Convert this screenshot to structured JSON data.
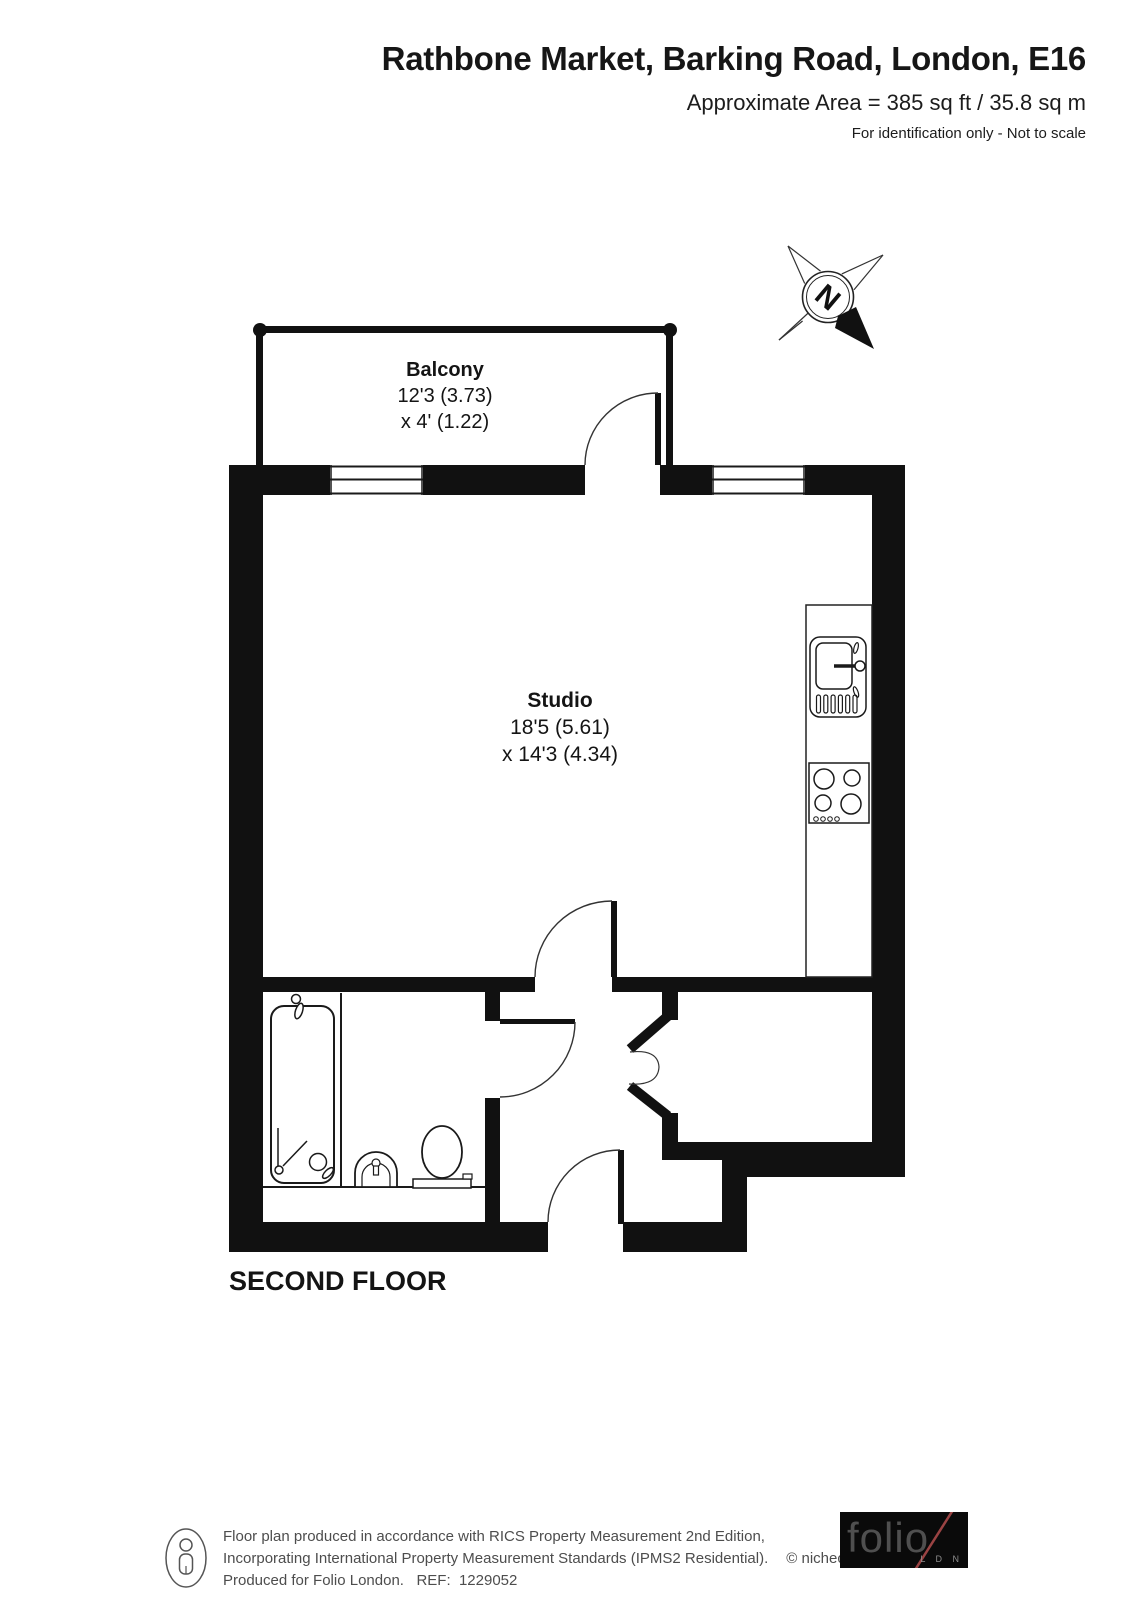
{
  "header": {
    "title": "Rathbone Market, Barking Road, London, E16",
    "area_line": "Approximate Area = 385 sq ft / 35.8 sq m",
    "disclaimer": "For identification only - Not to scale"
  },
  "compass": {
    "north_label": "N"
  },
  "rooms": {
    "balcony": {
      "name": "Balcony",
      "dim1": "12'3 (3.73)",
      "dim2": "x 4' (1.22)"
    },
    "studio": {
      "name": "Studio",
      "dim1": "18'5 (5.61)",
      "dim2": "x 14'3 (4.34)"
    }
  },
  "floor_label": "SECOND FLOOR",
  "footer": {
    "line1": "Floor plan produced in accordance with RICS Property Measurement 2nd Edition,",
    "line2": "Incorporating International Property Measurement Standards (IPMS2 Residential).",
    "copyright": "© nichecom 2025.",
    "line3": "Produced for Folio London.   REF:  1229052",
    "logo": {
      "text": "folio",
      "sub": "L D N"
    }
  },
  "colors": {
    "wall": "#111111",
    "line": "#1a1a1a",
    "slash": "#9a4343",
    "footer_text": "#4d4d4d"
  }
}
